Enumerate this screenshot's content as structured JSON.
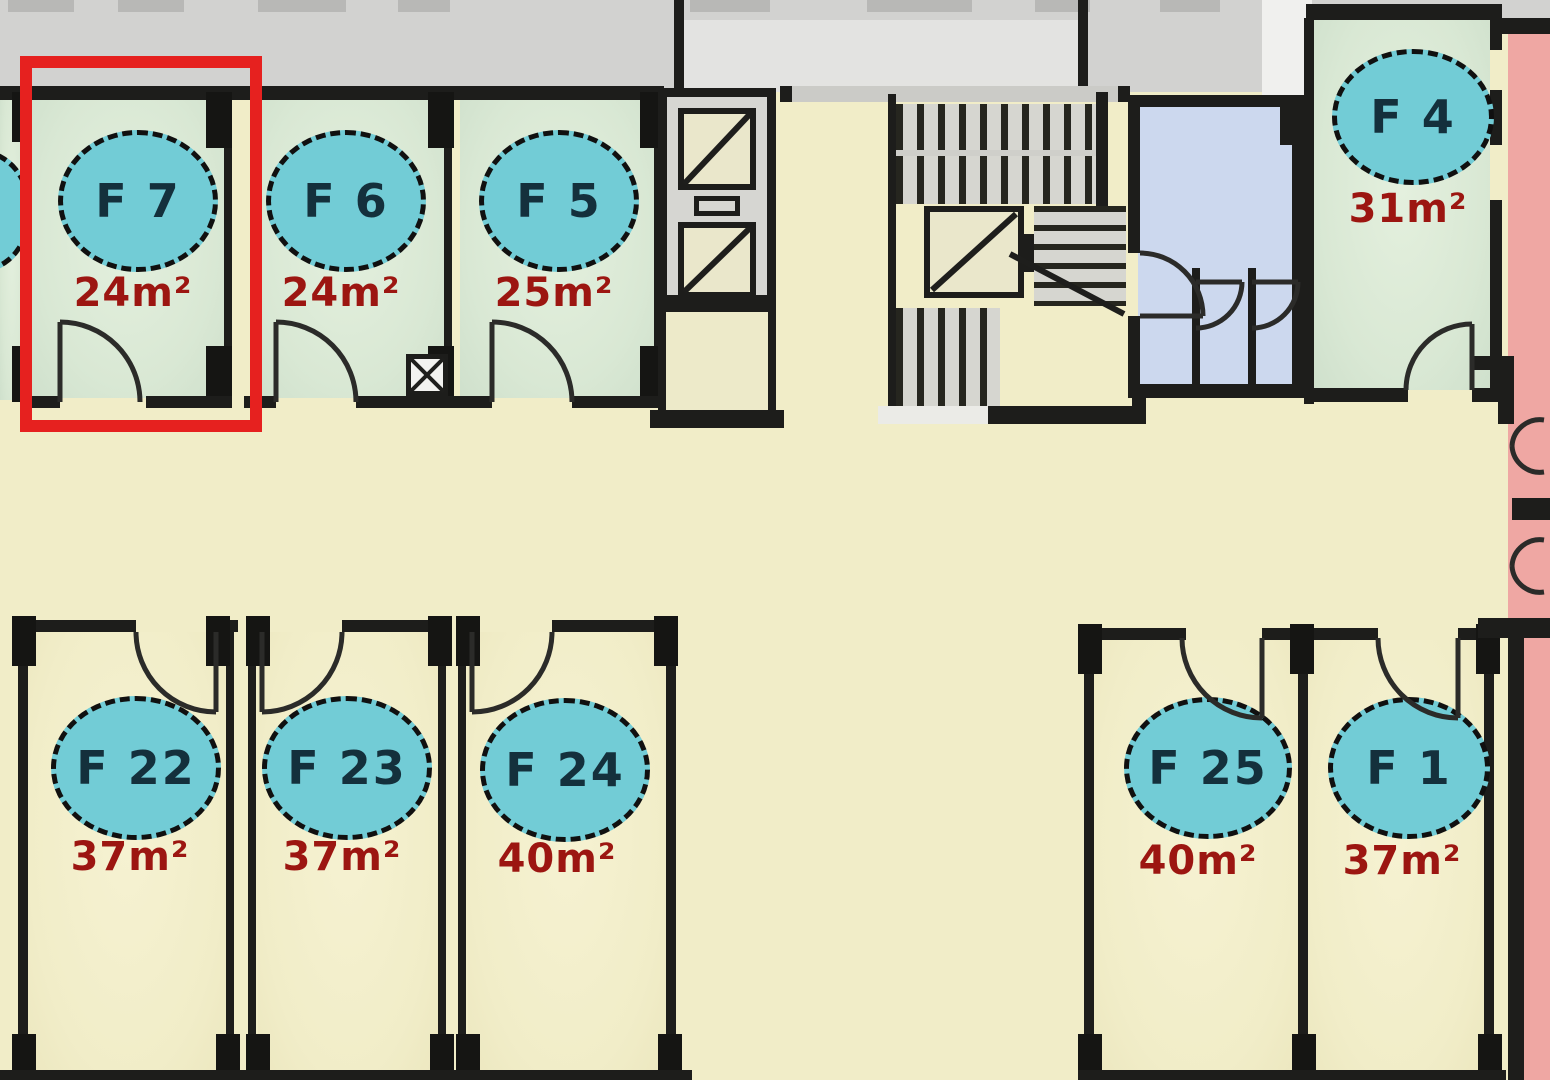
{
  "title": "Apartment floor plan",
  "highlight": {
    "unit": "F 7",
    "color": "#e6211f"
  },
  "units": [
    {
      "label": "F 7",
      "area": "24m²",
      "row": "top",
      "floor": "green",
      "highlighted": true
    },
    {
      "label": "F 6",
      "area": "24m²",
      "row": "top",
      "floor": "green",
      "highlighted": false
    },
    {
      "label": "F 5",
      "area": "25m²",
      "row": "top",
      "floor": "green",
      "highlighted": false
    },
    {
      "label": "F 4",
      "area": "31m²",
      "row": "top",
      "floor": "green",
      "highlighted": false
    },
    {
      "label": "F 22",
      "area": "37m²",
      "row": "bottom",
      "floor": "cream",
      "highlighted": false
    },
    {
      "label": "F 23",
      "area": "37m²",
      "row": "bottom",
      "floor": "cream",
      "highlighted": false
    },
    {
      "label": "F 24",
      "area": "40m²",
      "row": "bottom",
      "floor": "cream",
      "highlighted": false
    },
    {
      "label": "F 25",
      "area": "40m²",
      "row": "bottom",
      "floor": "cream",
      "highlighted": false
    },
    {
      "label": "F 1",
      "area": "37m²",
      "row": "bottom",
      "floor": "cream",
      "highlighted": false
    }
  ],
  "facilities": [
    "elevator-shaft",
    "stairwell",
    "core-elevator",
    "wc-room",
    "balcony"
  ],
  "colors": {
    "wall": "#1d1d1b",
    "unit_green": "#d9e8d4",
    "unit_cream": "#f1edc8",
    "corridor": "#f1edc8",
    "exterior_band": "#d2d2d0",
    "badge_fill": "#72ccd6",
    "badge_text": "#14303c",
    "area_text": "#9c1611",
    "wc_floor": "#ccd8ee",
    "balcony": "#efa7a3",
    "highlight": "#e6211f"
  }
}
